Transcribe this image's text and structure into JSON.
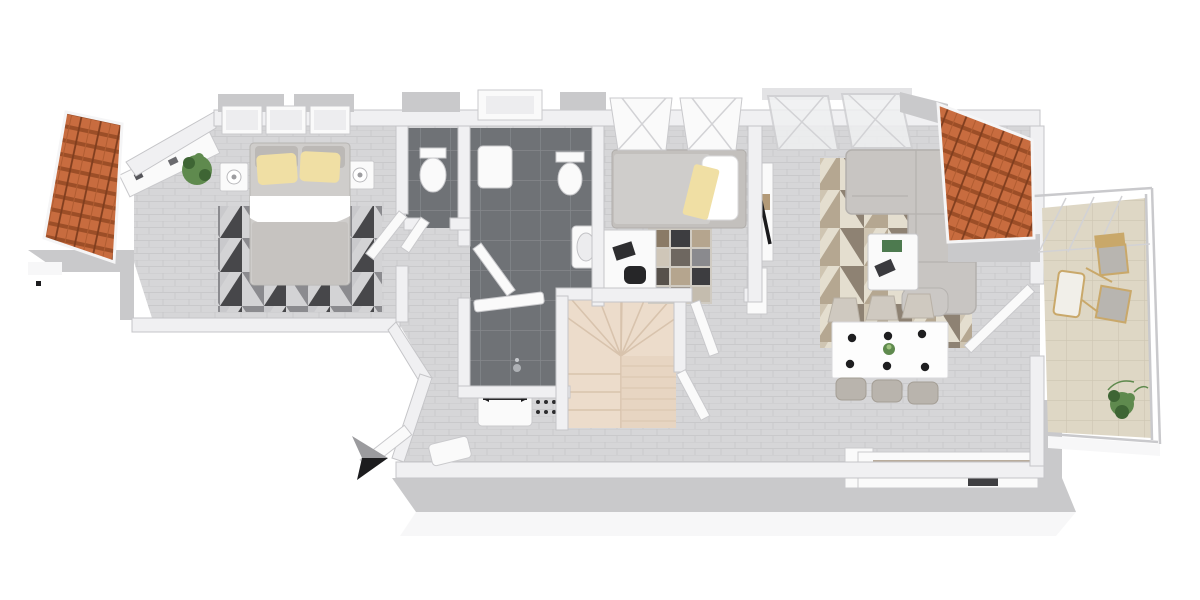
{
  "scene": {
    "type": "3d-floor-plan-render",
    "view": "top-down 3D dollhouse view, white background, no text labels",
    "level_hint": "attic storey: sloped orange roof panels left and right, stairs leading down, eaves along bottom edge",
    "compass": {
      "arrow_points": "right",
      "style": "black/grey 3-point arrow outside entrance"
    },
    "rooms": [
      {
        "id": "master-bedroom",
        "label": "Master bedroom",
        "furniture": [
          "double bed with grey headboard cushions",
          "two yellow pillows",
          "white duvet fold over grey blanket",
          "left nightstand with round lamp",
          "right nightstand with round lamp",
          "wall shelf with small decor items",
          "green potted plant",
          "dark geometric triangle rug",
          "three roof windows on top wall"
        ]
      },
      {
        "id": "wc",
        "label": "Separate WC",
        "furniture": [
          "wall-hung toilet",
          "dark grey tile floor"
        ]
      },
      {
        "id": "bathroom",
        "label": "Bathroom",
        "furniture": [
          "toilet",
          "wall-hung wash basin",
          "white storage / shower unit",
          "shower area with glass screen and drain",
          "white radiator",
          "doormat with dot pattern",
          "dark grey tile floor",
          "dormer window"
        ]
      },
      {
        "id": "staircase",
        "label": "Staircase",
        "furniture": [
          "cream U-shaped winder staircase",
          "door at lower right"
        ]
      },
      {
        "id": "bedroom-2",
        "label": "Second bedroom",
        "furniture": [
          "single bed with grey mattress",
          "white pillow",
          "yellow throw blanket",
          "white desk with laptop",
          "black desk chair",
          "patchwork rug in brown/grey/black",
          "two skylight roof windows"
        ]
      },
      {
        "id": "living-room",
        "label": "Living / dining room",
        "furniture": [
          "L-shaped grey sofa",
          "beige geometric triangle rug",
          "white coffee table with green and dark books",
          "tall white shelf with dark TV panel on bedroom wall",
          "white dining table",
          "six dining chairs (three per side)",
          "six black place settings",
          "green plant centerpiece",
          "two skylight roof windows",
          "open glass door to balcony"
        ]
      },
      {
        "id": "kitchen",
        "label": "Kitchenette",
        "furniture": [
          "white counter run along bottom wall",
          "beige-grey worktop",
          "dark built-in appliance"
        ]
      },
      {
        "id": "balcony",
        "label": "Balcony / loggia",
        "furniture": [
          "beige tile floor",
          "glass railing right and bottom",
          "glazed roof corner with beams",
          "two wooden chairs with grey cushions",
          "wooden lounge chair with white cushion",
          "green potted plant"
        ]
      }
    ],
    "exterior_elements": [
      "orange tiled roof panel upper left",
      "orange tiled roof panel upper right",
      "grey eave strip at left tip",
      "long grey eave with white fascia along bottom",
      "open white entrance door at angled bottom wall",
      "north arrow marker"
    ],
    "counts": {
      "dining_seats": 6,
      "place_settings": 6,
      "master_roof_windows": 3,
      "bedroom2_skylights": 2,
      "living_skylights": 2,
      "balcony_chairs": 3
    }
  },
  "colors": {
    "page-bg": "#ffffff",
    "floor": "#d6d6d8",
    "floor-line": "#c9c9cb",
    "floor-dark": "#6f7276",
    "floor-dark-line": "#85888c",
    "wall": "#f0f0f2",
    "wall-edge": "#c5c5c8",
    "eave": "#c9c9cb",
    "fascia": "#f7f7f8",
    "roof-tile": "#c86c3f",
    "roof-shadow": "#9c4e27",
    "roof-ridge": "#7f3d1e",
    "stairs": "#ecdccb",
    "stairs-line": "#d8c3ad",
    "sofa": "#c8c5c2",
    "sofa-edge": "#b3b0ad",
    "bed": "#cfcdcb",
    "pillow": "#f0dfa4",
    "duvet": "#ffffff",
    "blanket": "#c6c3c0",
    "balcony-floor": "#ded7c5",
    "balcony-line": "#cdc5b2",
    "wood": "#c9a86a",
    "plant": "#5f8a4e",
    "plant-dark": "#3e6534",
    "arrow-dark": "#1c1c1e",
    "arrow-light": "#9b9b9e",
    "white-fixture": "#fafafa",
    "appliance": "#3f3f42",
    "counter-top": "#b9ac9c"
  }
}
